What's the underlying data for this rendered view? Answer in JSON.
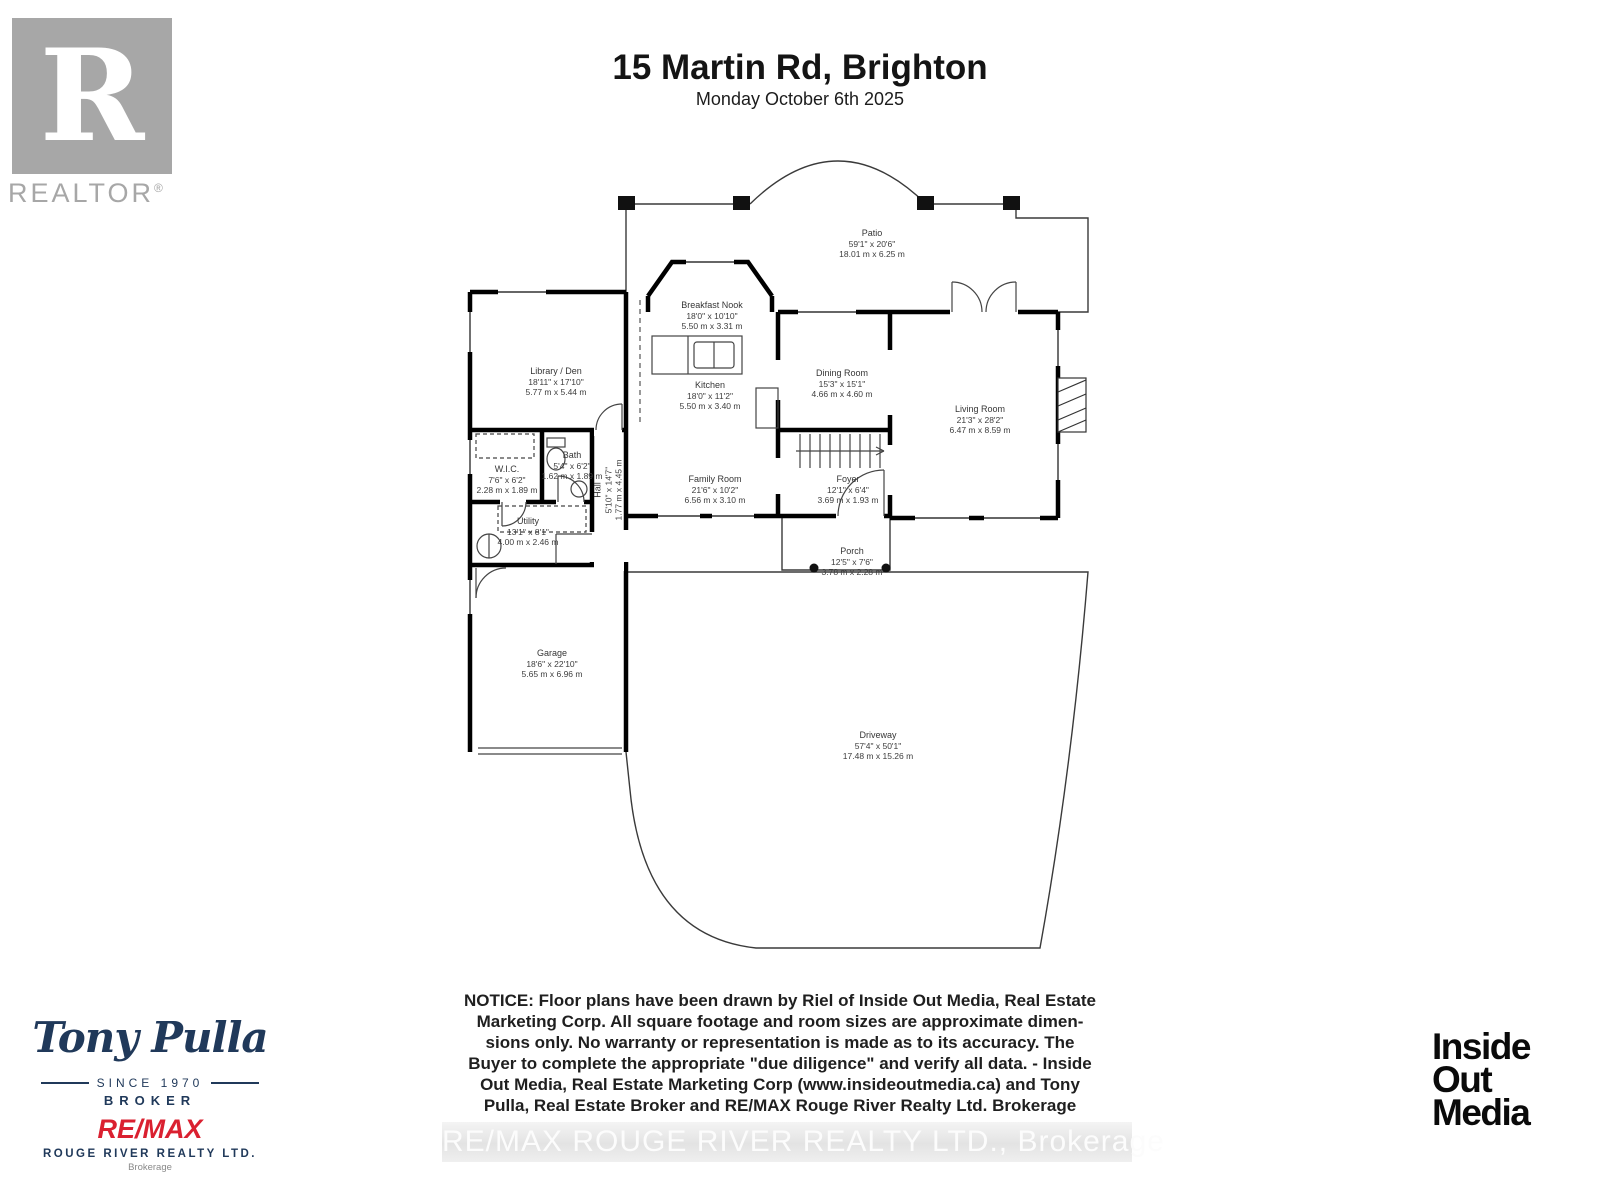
{
  "header": {
    "title": "15 Martin Rd, Brighton",
    "subtitle": "Monday October 6th 2025"
  },
  "realtor_logo": {
    "letter": "R",
    "label": "REALTOR",
    "registered": "®"
  },
  "rooms": {
    "patio": {
      "name": "Patio",
      "imperial": "59'1\" x 20'6\"",
      "metric": "18.01 m x 6.25 m"
    },
    "breakfast_nook": {
      "name": "Breakfast Nook",
      "imperial": "18'0\" x 10'10\"",
      "metric": "5.50 m x 3.31 m"
    },
    "kitchen": {
      "name": "Kitchen",
      "imperial": "18'0\" x 11'2\"",
      "metric": "5.50 m x 3.40 m"
    },
    "dining_room": {
      "name": "Dining Room",
      "imperial": "15'3\" x 15'1\"",
      "metric": "4.66 m x 4.60 m"
    },
    "living_room": {
      "name": "Living Room",
      "imperial": "21'3\" x 28'2\"",
      "metric": "6.47 m x 8.59 m"
    },
    "library_den": {
      "name": "Library / Den",
      "imperial": "18'11\" x 17'10\"",
      "metric": "5.77 m x 5.44 m"
    },
    "wic": {
      "name": "W.I.C.",
      "imperial": "7'6\" x 6'2\"",
      "metric": "2.28 m x 1.89 m"
    },
    "bath": {
      "name": "Bath",
      "imperial": "5'4\" x 6'2\"",
      "metric": "1.62 m x 1.89 m"
    },
    "hall": {
      "name": "Hall",
      "imperial": "5'10\" x 14'7\"",
      "metric": "1.77 m x 4.45 m"
    },
    "family_room": {
      "name": "Family Room",
      "imperial": "21'6\" x 10'2\"",
      "metric": "6.56 m x 3.10 m"
    },
    "foyer": {
      "name": "Foyer",
      "imperial": "12'1\" x 6'4\"",
      "metric": "3.69 m x 1.93 m"
    },
    "utility": {
      "name": "Utility",
      "imperial": "13'1\" x 8'1\"",
      "metric": "4.00 m x 2.46 m"
    },
    "garage": {
      "name": "Garage",
      "imperial": "18'6\" x 22'10\"",
      "metric": "5.65 m x 6.96 m"
    },
    "porch": {
      "name": "Porch",
      "imperial": "12'5\" x 7'6\"",
      "metric": "3.78 m x 2.28 m"
    },
    "driveway": {
      "name": "Driveway",
      "imperial": "57'4\" x 50'1\"",
      "metric": "17.48 m x 15.26 m"
    }
  },
  "notice": {
    "text": "NOTICE: Floor plans have been drawn by Riel of Inside Out Media, Real Estate\nMarketing Corp. All square footage and room sizes are approximate dimen-\nsions only. No warranty or representation is made as to its accuracy. The\nBuyer to complete the appropriate \"due diligence\" and verify all data. - Inside\nOut Media, Real Estate Marketing Corp (www.insideoutmedia.ca) and Tony\nPulla, Real Estate Broker and RE/MAX Rouge River Realty Ltd. Brokerage"
  },
  "watermark": {
    "text": "RE/MAX ROUGE RIVER REALTY LTD., Brokerage"
  },
  "agent_branding": {
    "name": "Tony Pulla",
    "since": "SINCE 1970",
    "role": "BROKER",
    "brand": "RE/MAX",
    "company": "ROUGE RIVER REALTY LTD.",
    "brokerage": "Brokerage",
    "brand_color": "#da2030",
    "navy_color": "#20395a"
  },
  "media_logo": {
    "line1": "Inside",
    "line2": "Out",
    "line3": "Media"
  }
}
